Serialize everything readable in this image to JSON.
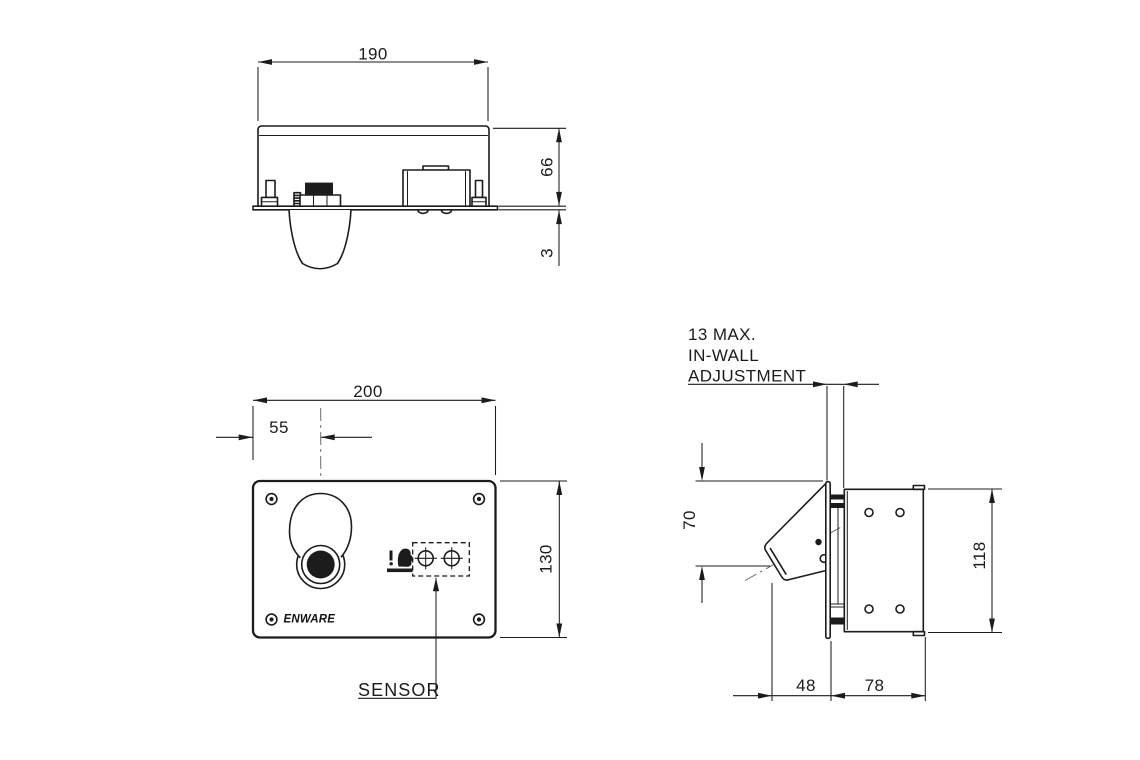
{
  "colors": {
    "line": "#1c1c1c",
    "background": "#ffffff",
    "centerline": "#6e6e6e"
  },
  "brand": {
    "logo_text": "ENWARE"
  },
  "views": {
    "top_view": {
      "dim_width": "190",
      "dim_height": "66",
      "dim_plate_thickness": "3"
    },
    "front_view": {
      "dim_width": "200",
      "dim_spout_offset": "55",
      "dim_height": "130",
      "label_sensor": "SENSOR"
    },
    "side_view": {
      "note_line1": "13 MAX.",
      "note_line2": "IN-WALL",
      "note_line3": "ADJUSTMENT",
      "dim_spout_drop": "70",
      "dim_box_height": "118",
      "dim_spout_projection": "48",
      "dim_box_depth": "78"
    }
  }
}
